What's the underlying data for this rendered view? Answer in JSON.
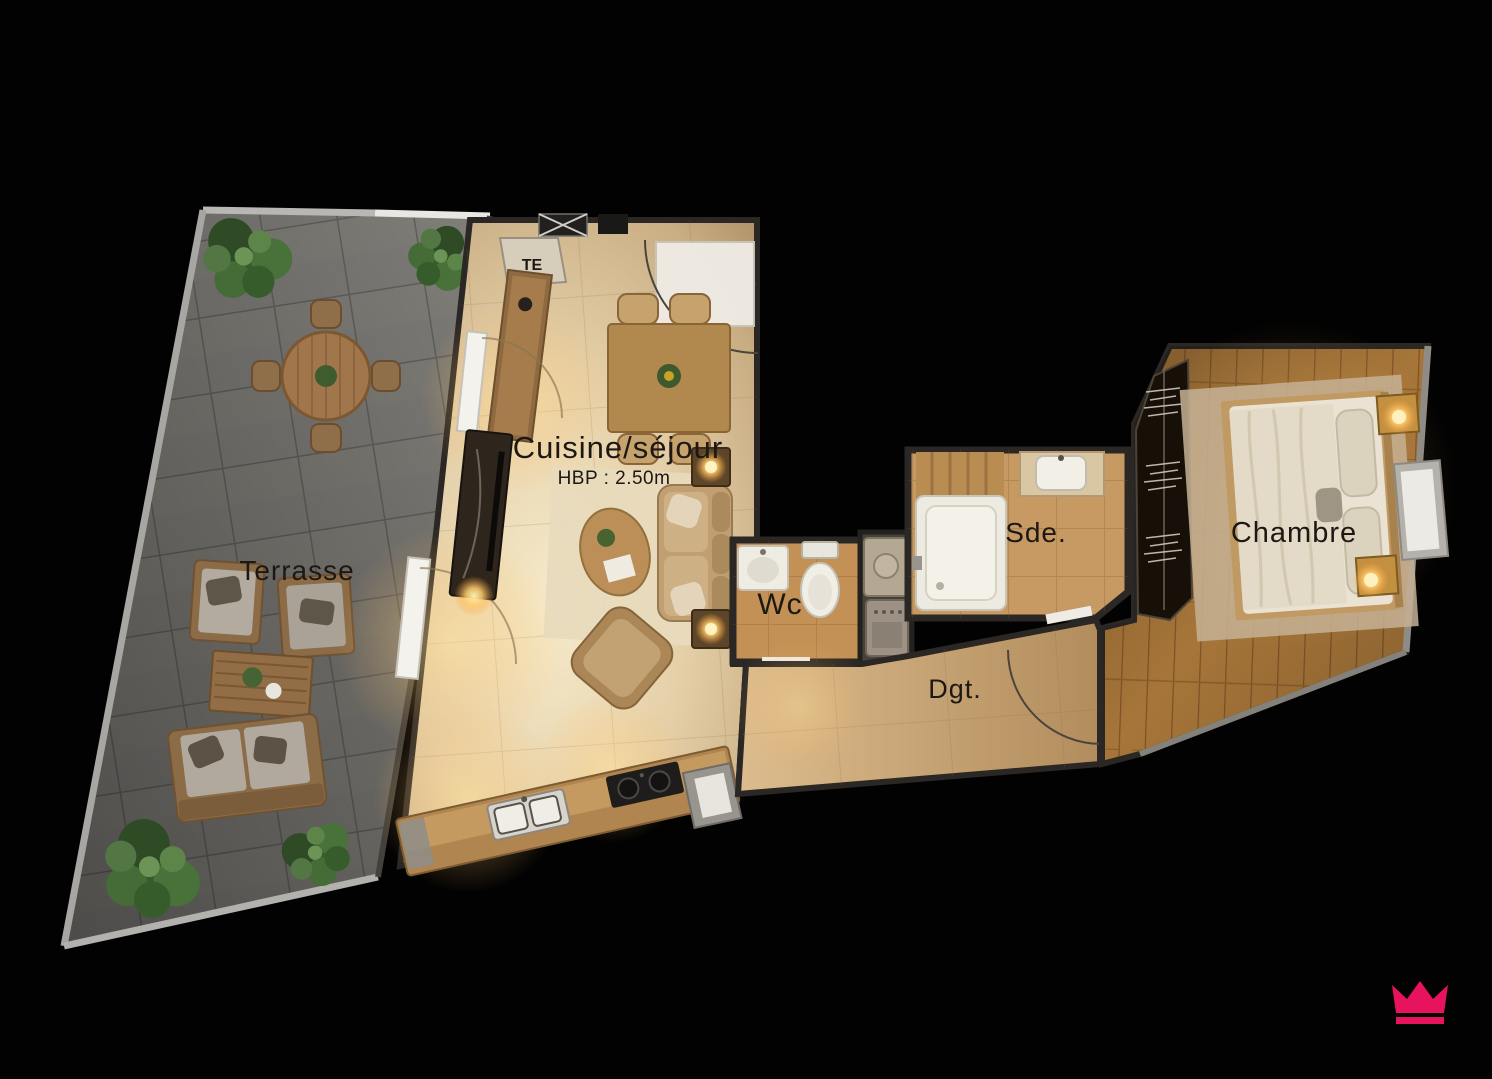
{
  "scene": {
    "type": "apartment-floorplan-render",
    "background": "#000000"
  },
  "labels": {
    "terrasse": "Terrasse",
    "cuisine_sejour": "Cuisine/séjour",
    "cuisine_sejour_height": "HBP : 2.50m",
    "wc": "Wc",
    "sde": "Sde.",
    "dgt": "Dgt.",
    "chambre": "Chambre",
    "te": "TE"
  },
  "colors": {
    "background": "#000000",
    "terrace_tile": "#7f7d79",
    "living_floor": "#e4cfa8",
    "wet_room_floor": "#c39055",
    "hall_floor": "#cfa97b",
    "bedroom_wood": "#a67539",
    "label_text": "#1d1814",
    "logo_pink": "#e8135f"
  },
  "logo": {
    "icon": "crown-icon",
    "color": "#e8135f"
  }
}
